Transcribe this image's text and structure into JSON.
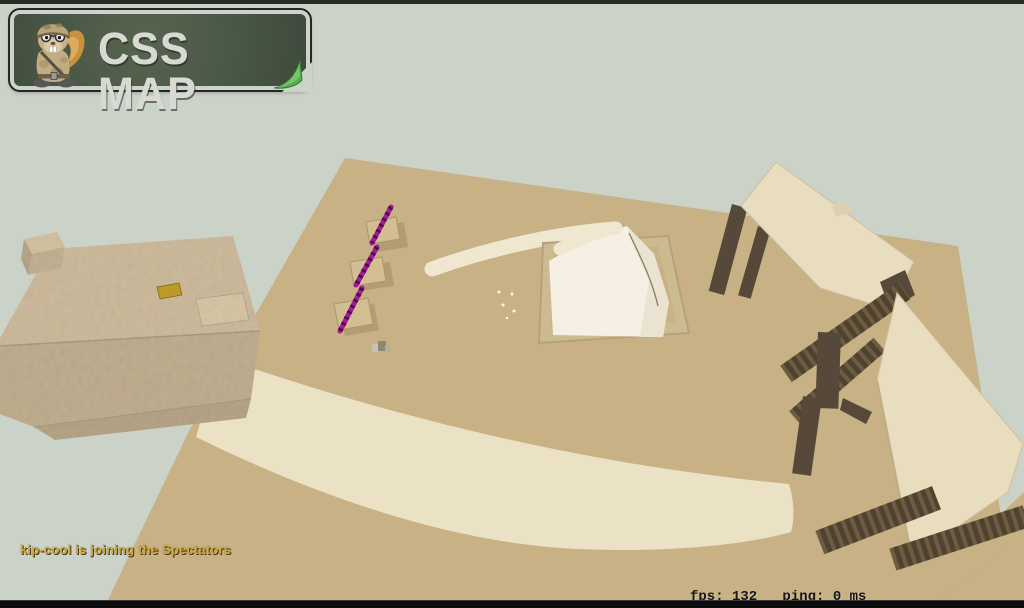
{
  "chrome": {
    "top_bar_color": "#262d26",
    "bottom_bar_color": "#0d0d0d"
  },
  "logo": {
    "title": "CSS MAP",
    "mascot": "hamster-soldier-mascot",
    "panel_color": "#4c5a48",
    "border_color": "#cdd2cc",
    "curl_color": "#55b050",
    "text_color": "#d9d9d4"
  },
  "hud": {
    "chat_message": "kip-cool is joining the Spectators",
    "chat_color": "#d1aa42",
    "stats_text": "fps: 132   ping: 0 ms",
    "fps_label": "fps:",
    "fps_value": "132",
    "ping_label": "ping:",
    "ping_value": "0 ms",
    "stats_color": "#161616"
  },
  "scene": {
    "description": "Spectator overview of a sandy bhop-style map",
    "sky_color": "#cbd2c8",
    "ground_color": "#c8b185",
    "road_color": "#ebe1c5",
    "ramp_color": "#f0e7d1",
    "mound_color": "#f5f0e3",
    "mound_shade_color": "#eae3d1",
    "frame_color": "#ccba90",
    "frame_inner_color": "#c8b185",
    "slab_color": "#e9ddbf",
    "wood_color": "#57493a",
    "rung_light_color": "#6d5c43",
    "building_top_color": "#c5af8d",
    "building_front_color": "#b19b78",
    "building_dark_color": "#a28b68",
    "building_step_color": "#d4c09c",
    "cube_top_color": "#cfbb95",
    "cube_front_color": "#b4a07d",
    "cube_side_color": "#a38e6c",
    "marker_color": "#bd992a",
    "purple_color": "#a6189b",
    "purple_dark_color": "#4a0c45",
    "pad_color": "#d2be92",
    "pad_shadow_color": "#b29c72",
    "particle_color": "#fdf9ec",
    "objects": [
      {
        "name": "stone-building",
        "desc": "large sandstone block structure with yellow marker"
      },
      {
        "name": "spiral-mound",
        "desc": "white mound on framed platform with curved ramp"
      },
      {
        "name": "beacon-pads",
        "desc": "three small pads with purple beacons"
      },
      {
        "name": "elevated-slabs",
        "desc": "cream platforms resting on wooden pillars"
      },
      {
        "name": "ladder-beams",
        "desc": "dark wooden ladder beams on the sand"
      },
      {
        "name": "curved-road",
        "desc": "wide pale curved road across the sand"
      }
    ]
  }
}
